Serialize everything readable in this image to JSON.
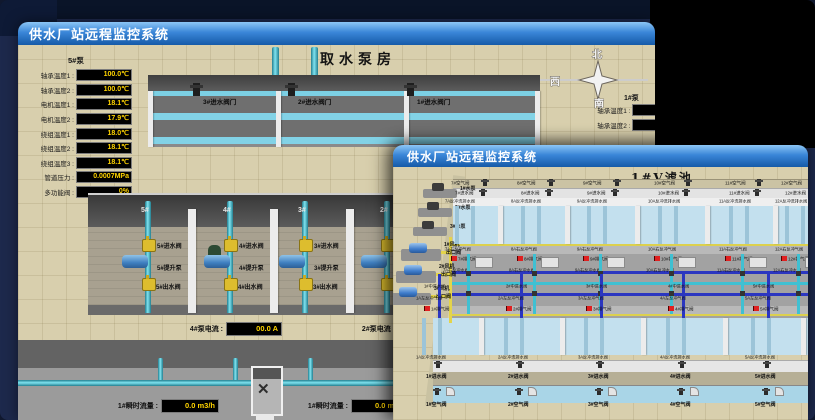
{
  "colors": {
    "titlebar_blue": "#3a86d8",
    "value_yellow": "#ffd400",
    "alarm_red": "#e02020",
    "pipe_teal": "#45b5c8",
    "water_blue": "#c3e0ee",
    "valve_yellow": "#ddbd2e",
    "floor_tan": "#d8cfad"
  },
  "back_window": {
    "title": "供水厂站远程监控系统",
    "scene_title": "取水泵房",
    "pump_panel": {
      "header": "5#泵",
      "rows": [
        {
          "label": "轴承温度1",
          "value": "100.0℃"
        },
        {
          "label": "轴承温度2",
          "value": "100.0℃"
        },
        {
          "label": "电机温度1",
          "value": "18.1℃"
        },
        {
          "label": "电机温度2",
          "value": "17.9℃"
        },
        {
          "label": "绕组温度1",
          "value": "18.0℃"
        },
        {
          "label": "绕组温度2",
          "value": "18.1℃"
        },
        {
          "label": "绕组温度3",
          "value": "18.1℃"
        },
        {
          "label": "管道压力",
          "value": "0.0007MPa"
        },
        {
          "label": "多功能阀",
          "value": "0%"
        }
      ]
    },
    "intake_valves": [
      "3#进水阀门",
      "2#进水阀门",
      "1#进水阀门"
    ],
    "compass": {
      "north": "北",
      "west": "西",
      "south": "南"
    },
    "right_panel": {
      "header": "1#泵",
      "labels": [
        "轴承温度1",
        "轴承温度2"
      ]
    },
    "pump_bays": [
      {
        "id": "5#",
        "inlet": "5#进水阀",
        "pump": "5#提升泵",
        "outlet": "5#出水阀"
      },
      {
        "id": "4#",
        "inlet": "4#进水阀",
        "pump": "4#提升泵",
        "outlet": "4#出水阀"
      },
      {
        "id": "3#",
        "inlet": "3#进水阀",
        "pump": "3#提升泵",
        "outlet": "3#出水阀"
      },
      {
        "id": "2#",
        "inlet": "2#进水阀",
        "pump": "2#提升泵",
        "outlet": "2#出水阀"
      }
    ],
    "current_readouts": [
      {
        "label": "4#泵电流",
        "value": "00.0 A"
      },
      {
        "label": "2#泵电流"
      }
    ],
    "flow_readouts": [
      {
        "label": "1#瞬时流量",
        "value": "0.0 m3/h"
      },
      {
        "label": "1#瞬时流量",
        "value": "0.0 m3/h"
      }
    ]
  },
  "front_window": {
    "title": "供水厂站远程监控系统",
    "scene_title": "1#V滤池",
    "left_pumps": [
      "1#水泵",
      "2#水泵",
      "3#水泵"
    ],
    "blowers": [
      {
        "label": "1#风机",
        "sub": "出口阀"
      },
      {
        "label": "2#风机",
        "sub": "出口阀"
      },
      {
        "label": "3#风机",
        "sub": "出口阀"
      }
    ],
    "top_cells": [
      {
        "air": "7#空气阀",
        "inlet": "7#进水阀",
        "drain": "7A反冲洗排水阀",
        "gas": "7A右反冲气阀",
        "vent": "7#排气阀",
        "wash": "7A右反冲水阀"
      },
      {
        "air": "8#空气阀",
        "inlet": "8#进水阀",
        "drain": "8A反冲洗排水阀",
        "gas": "8A右反冲气阀",
        "vent": "8#排气阀",
        "wash": "8A右反冲水阀"
      },
      {
        "air": "9#空气阀",
        "inlet": "9#进水阀",
        "drain": "9A反冲洗排水阀",
        "gas": "9A右反冲气阀",
        "vent": "9#排气阀",
        "wash": "9A右反冲水阀"
      },
      {
        "air": "10#空气阀",
        "inlet": "10#进水阀",
        "drain": "10A反冲洗排水阀",
        "gas": "10A右反冲气阀",
        "vent": "10#排气阀",
        "wash": "10A右反冲水阀"
      },
      {
        "air": "11#空气阀",
        "inlet": "11#进水阀",
        "drain": "11A反冲洗排水阀",
        "gas": "11A右反冲气阀",
        "vent": "11#排气阀",
        "wash": "11A右反冲水阀"
      },
      {
        "air": "12#空气阀",
        "inlet": "12#进水阀",
        "drain": "12A反冲洗排水阀",
        "gas": "12A右反冲气阀",
        "vent": "12#排气阀",
        "wash": "12A右反冲水阀"
      }
    ],
    "bottom_cells": [
      {
        "mid_inlet": "1#中进水阀",
        "gas": "1A左反冲气阀",
        "vent": "1#排气阀",
        "drain": "1A反冲洗排水阀",
        "inlet": "1#进水阀",
        "air": "1#空气阀"
      },
      {
        "mid_inlet": "2#中进水阀",
        "gas": "2A左反冲气阀",
        "vent": "2#排气阀",
        "drain": "2A反冲洗排水阀",
        "inlet": "2#进水阀",
        "air": "2#空气阀"
      },
      {
        "mid_inlet": "3#中进水阀",
        "gas": "3A左反冲气阀",
        "vent": "3#排气阀",
        "drain": "3A反冲洗排水阀",
        "inlet": "3#进水阀",
        "air": "3#空气阀"
      },
      {
        "mid_inlet": "4#中进水阀",
        "gas": "4A左反冲气阀",
        "vent": "4#排气阀",
        "drain": "4A反冲洗排水阀",
        "inlet": "4#进水阀",
        "air": "4#空气阀"
      },
      {
        "mid_inlet": "5#中进水阀",
        "gas": "5A左反冲气阀",
        "vent": "5#排气阀",
        "drain": "5A反冲洗排水阀",
        "inlet": "5#进水阀",
        "air": "5#空气阀"
      }
    ]
  }
}
